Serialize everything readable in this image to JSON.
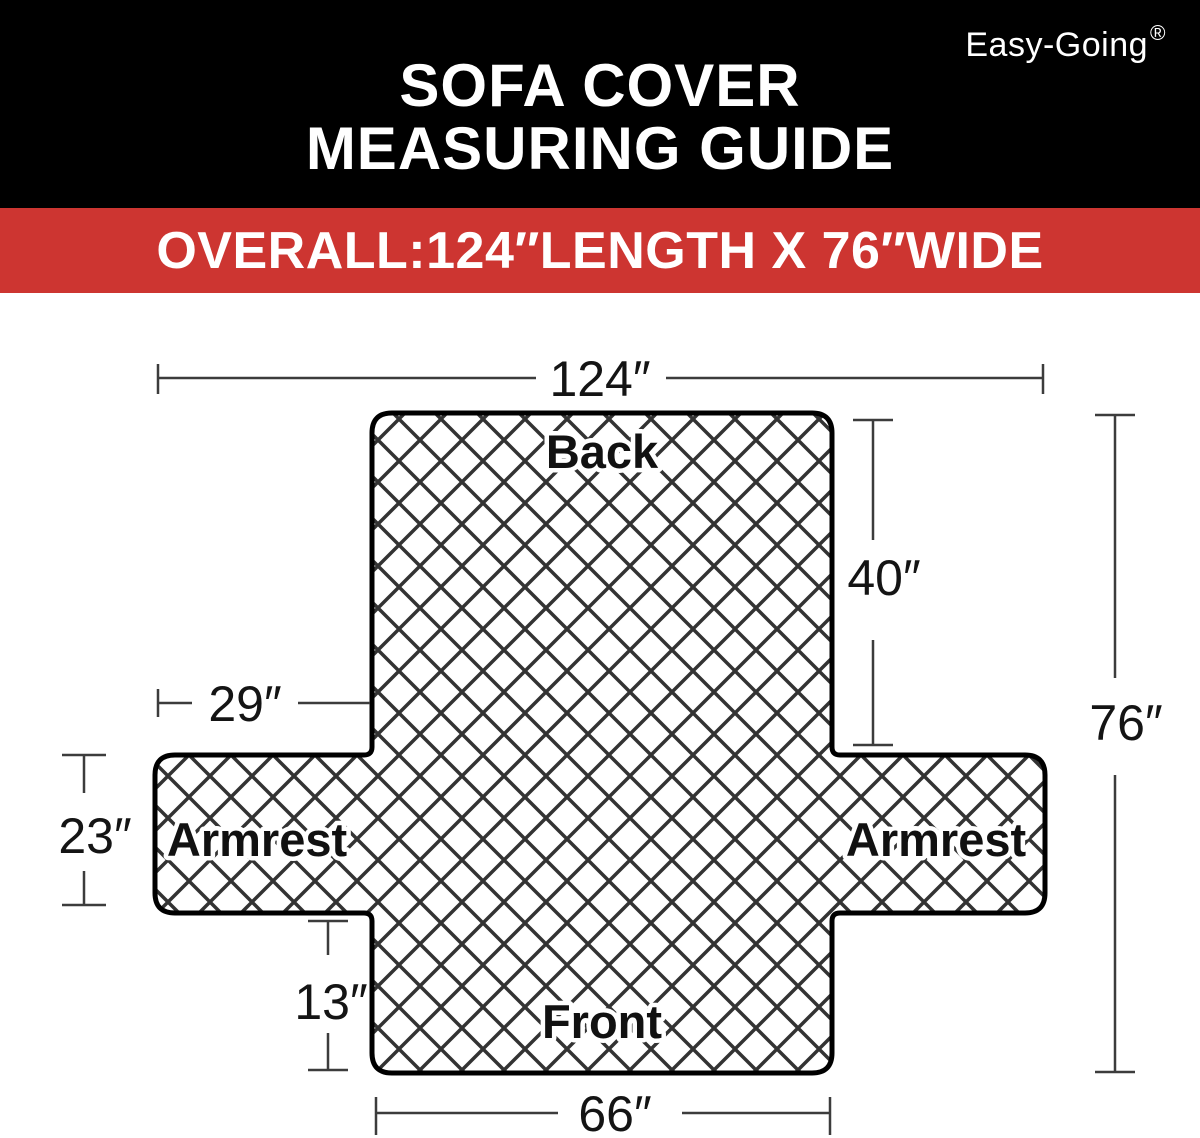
{
  "brand": {
    "name": "Easy-Going",
    "registered_mark": "®"
  },
  "header": {
    "title_line1": "SOFA COVER",
    "title_line2": "MEASURING GUIDE"
  },
  "banner": {
    "text": "OVERALL:124″LENGTH X 76″WIDE"
  },
  "colors": {
    "header_background": "#000000",
    "banner_background": "#cd3531",
    "outline": "#000000",
    "pattern_line": "#333333",
    "dimension_line": "#3c3c3c"
  },
  "diagram": {
    "labels": {
      "back": "Back",
      "armrest_left": "Armrest",
      "armrest_right": "Armrest",
      "front": "Front"
    },
    "dimensions": {
      "overall_length": "124″",
      "back_height": "40″",
      "overall_width": "76″",
      "armrest_length": "29″",
      "armrest_width": "23″",
      "front_height": "13″",
      "front_width": "66″"
    }
  }
}
